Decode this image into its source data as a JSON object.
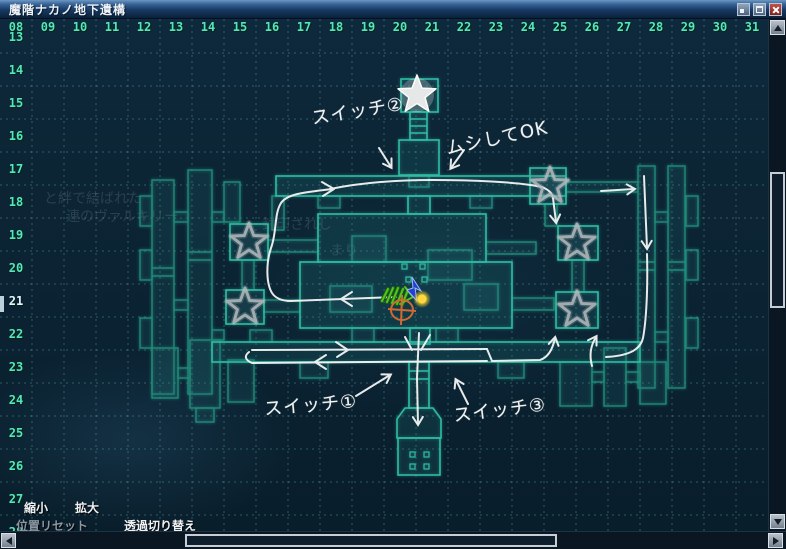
{
  "window": {
    "title": "魔階ナカノ地下遺構"
  },
  "axes": {
    "top": [
      "08",
      "09",
      "10",
      "11",
      "12",
      "13",
      "14",
      "15",
      "16",
      "17",
      "18",
      "19",
      "20",
      "21",
      "22",
      "23",
      "24",
      "25",
      "26",
      "27",
      "28",
      "29",
      "30",
      "31"
    ],
    "left": [
      "13",
      "14",
      "15",
      "16",
      "17",
      "18",
      "19",
      "20",
      "21",
      "22",
      "23",
      "24",
      "25",
      "26",
      "27",
      "28"
    ],
    "highlighted_row": "21"
  },
  "map": {
    "stars": [
      {
        "x": 417,
        "y": 95,
        "filled": true
      },
      {
        "x": 249,
        "y": 242,
        "filled": false
      },
      {
        "x": 245,
        "y": 307,
        "filled": false
      },
      {
        "x": 550,
        "y": 186,
        "filled": false
      },
      {
        "x": 577,
        "y": 243,
        "filled": false
      },
      {
        "x": 577,
        "y": 310,
        "filled": false
      }
    ],
    "annotations": [
      {
        "id": "switch-2",
        "text": "スイッチ②",
        "x": 311,
        "y": 97,
        "rot": -9
      },
      {
        "id": "ignore-ok",
        "text": "ムシしてOK",
        "x": 445,
        "y": 124,
        "rot": -12
      },
      {
        "id": "switch-1",
        "text": "スイッチ①",
        "x": 264,
        "y": 391,
        "rot": -5
      },
      {
        "id": "switch-3",
        "text": "スイッチ③",
        "x": 453,
        "y": 396,
        "rot": -7
      }
    ],
    "watermarks": [
      {
        "text": "と絆で結ばれた",
        "x": 44,
        "y": 203
      },
      {
        "text": "連のヴァルキリー",
        "x": 66,
        "y": 221
      },
      {
        "text": "封印されし",
        "x": 262,
        "y": 229
      },
      {
        "text": "まり",
        "x": 330,
        "y": 255
      }
    ]
  },
  "toolbar": {
    "zoom_out": "縮小",
    "zoom_in": "拡大",
    "reset_position": "位置リセット",
    "transparency_toggle": "透過切り替え"
  },
  "colors": {
    "map_outline_bright": "#2fbda2",
    "map_outline_dim": "#1f8a77",
    "route_ink": "#f3f5f4",
    "axis_text": "#54e8b4",
    "grid_line": "rgba(110,215,205,0.33)",
    "player_marker_blue": "#2140d6",
    "target_dot_yellow": "#ffd83d",
    "hand_circle_orange": "#cf6a33",
    "hand_arrow_green": "#55c41e",
    "close_button_red": "#a03028"
  }
}
